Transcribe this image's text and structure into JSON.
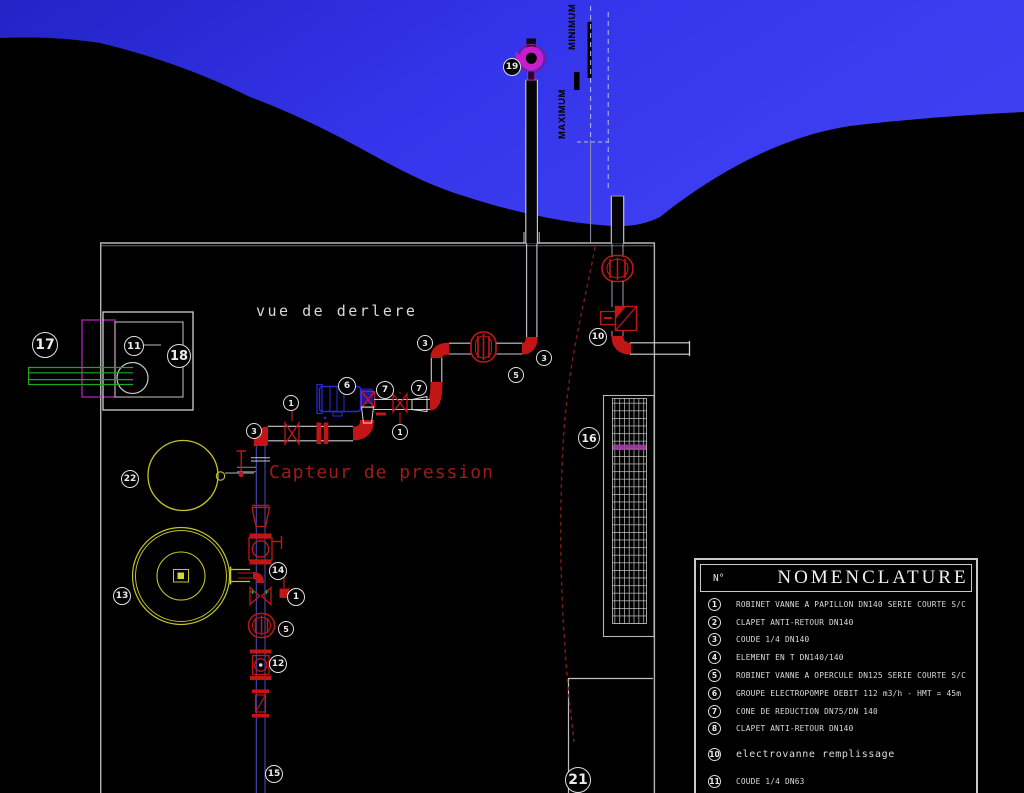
{
  "annotations": {
    "view_label": "vue de derlere",
    "pressure_sensor_label": "Capteur de pression",
    "level_min_label": "MINIMUM",
    "level_max_label": "MAXIMUM"
  },
  "callouts": [
    {
      "n": "19",
      "x": 511,
      "y": 66,
      "r": 8
    },
    {
      "n": "17",
      "x": 44,
      "y": 344,
      "r": 12
    },
    {
      "n": "11",
      "x": 133,
      "y": 345,
      "r": 9
    },
    {
      "n": "18",
      "x": 178,
      "y": 355,
      "r": 11
    },
    {
      "n": "3",
      "x": 424,
      "y": 342,
      "r": 7
    },
    {
      "n": "3",
      "x": 543,
      "y": 357,
      "r": 7
    },
    {
      "n": "5",
      "x": 515,
      "y": 374,
      "r": 7
    },
    {
      "n": "10",
      "x": 597,
      "y": 336,
      "r": 8
    },
    {
      "n": "16",
      "x": 588,
      "y": 437,
      "r": 10
    },
    {
      "n": "22",
      "x": 129,
      "y": 478,
      "r": 8
    },
    {
      "n": "3",
      "x": 253,
      "y": 430,
      "r": 7
    },
    {
      "n": "1",
      "x": 290,
      "y": 402,
      "r": 7
    },
    {
      "n": "6",
      "x": 346,
      "y": 385,
      "r": 8
    },
    {
      "n": "7",
      "x": 384,
      "y": 389,
      "r": 8
    },
    {
      "n": "7",
      "x": 418,
      "y": 387,
      "r": 7
    },
    {
      "n": "1",
      "x": 399,
      "y": 431,
      "r": 7
    },
    {
      "n": "13",
      "x": 121,
      "y": 595,
      "r": 8
    },
    {
      "n": "14",
      "x": 277,
      "y": 570,
      "r": 8
    },
    {
      "n": "1",
      "x": 295,
      "y": 596,
      "r": 8
    },
    {
      "n": "5",
      "x": 285,
      "y": 628,
      "r": 7
    },
    {
      "n": "12",
      "x": 277,
      "y": 663,
      "r": 8
    },
    {
      "n": "15",
      "x": 273,
      "y": 773,
      "r": 8
    },
    {
      "n": "21",
      "x": 577,
      "y": 779,
      "r": 12
    }
  ],
  "nomenclature": {
    "col_no": "N°",
    "title": "NOMENCLATURE",
    "rows": [
      {
        "num": "1",
        "label": "ROBINET VANNE A PAPILLON DN140 SERIE COURTE S/C"
      },
      {
        "num": "2",
        "label": "CLAPET ANTI-RETOUR DN140"
      },
      {
        "num": "3",
        "label": "COUDE 1/4 DN140"
      },
      {
        "num": "4",
        "label": "ELEMENT EN T DN140/140"
      },
      {
        "num": "5",
        "label": "ROBINET VANNE A OPERCULE DN125 SERIE COURTE S/C"
      },
      {
        "num": "6",
        "label": "GROUPE ELECTROPOMPE DEBIT 112 m3/h - HMT = 45m"
      },
      {
        "num": "7",
        "label": "CONE DE REDUCTION DN75/DN 140"
      },
      {
        "num": "8",
        "label": "CLAPET ANTI-RETOUR DN140"
      },
      {
        "num": "10",
        "label": "electrovanne remplissage"
      },
      {
        "num": "11",
        "label": "COUDE 1/4 DN63"
      }
    ]
  },
  "colors": {
    "red": "#c21616",
    "pump_blue": "#2a2ae0",
    "magenta": "#c81ec8",
    "green": "#21a821",
    "tank_yellow": "#c3c32a",
    "water_blue": "#3434e8"
  }
}
